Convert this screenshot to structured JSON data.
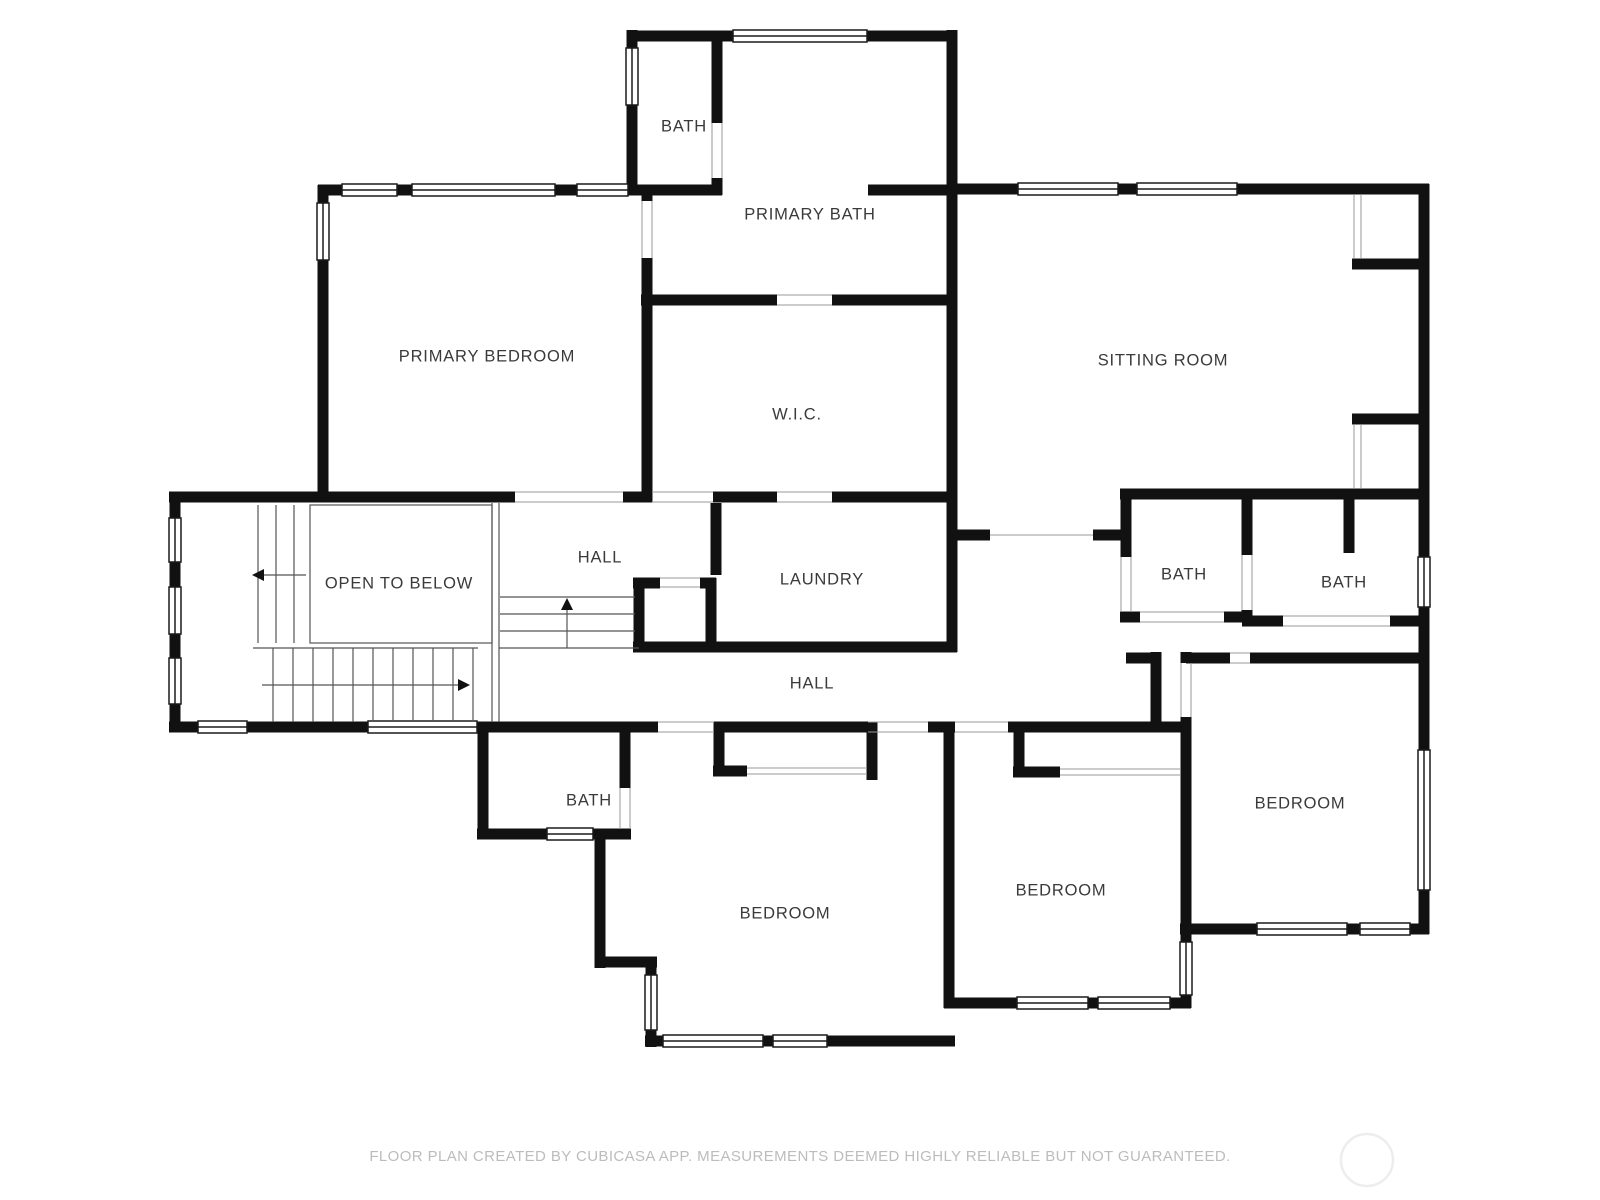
{
  "plan": {
    "title": "Second floor plan",
    "wall_color": "#111111",
    "thin_line_color": "#8a8a8a",
    "label_color": "#3a3a3a",
    "background": "#ffffff"
  },
  "rooms": [
    {
      "id": "bath-top",
      "label": "BATH"
    },
    {
      "id": "primary-bath",
      "label": "PRIMARY BATH"
    },
    {
      "id": "primary-bedroom",
      "label": "PRIMARY BEDROOM"
    },
    {
      "id": "wic",
      "label": "W.I.C."
    },
    {
      "id": "sitting-room",
      "label": "SITTING ROOM"
    },
    {
      "id": "open-to-below",
      "label": "OPEN TO BELOW"
    },
    {
      "id": "hall-upper",
      "label": "HALL"
    },
    {
      "id": "laundry",
      "label": "LAUNDRY"
    },
    {
      "id": "bath-mid-left",
      "label": "BATH"
    },
    {
      "id": "bath-mid-right",
      "label": "BATH"
    },
    {
      "id": "hall-lower",
      "label": "HALL"
    },
    {
      "id": "bath-bottom",
      "label": "BATH"
    },
    {
      "id": "bedroom-center",
      "label": "BEDROOM"
    },
    {
      "id": "bedroom-middle",
      "label": "BEDROOM"
    },
    {
      "id": "bedroom-right",
      "label": "BEDROOM"
    }
  ],
  "footer": {
    "text": "FLOOR PLAN CREATED BY CUBICASA APP. MEASUREMENTS DEEMED HIGHLY RELIABLE BUT NOT GUARANTEED."
  }
}
